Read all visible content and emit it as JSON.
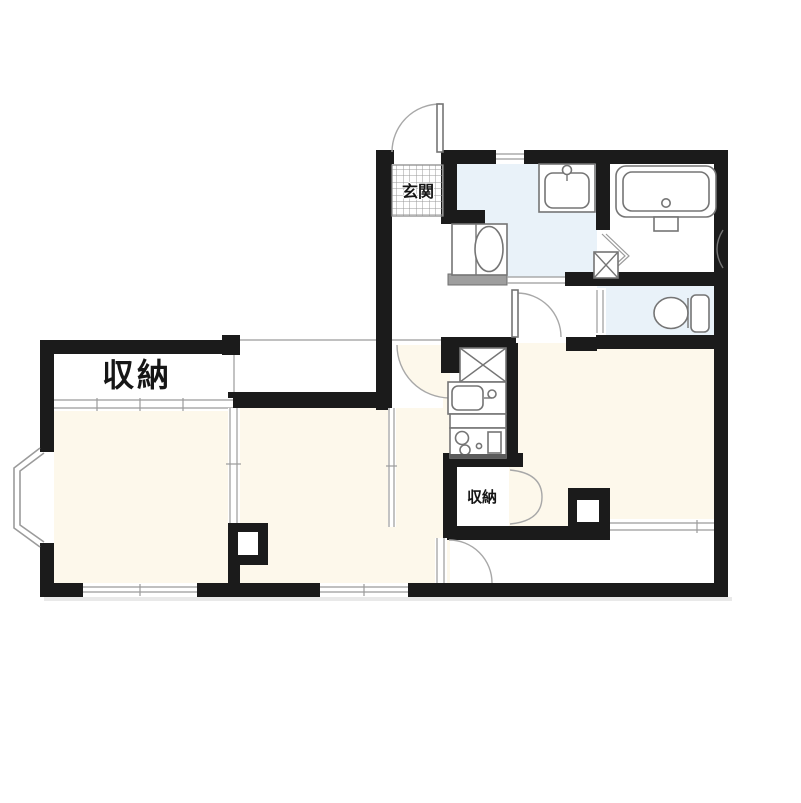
{
  "page": {
    "background": "#ffffff"
  },
  "floorplan": {
    "labels": {
      "entrance": "玄関",
      "storage_large": "収納",
      "storage_small": "収納"
    },
    "colors": {
      "wall": "#1b1b1b",
      "room_floor": "#FDF8EB",
      "wet_area_floor": "#E9F2F9",
      "fixture_line": "#757575",
      "thin_line": "#9b9b9b",
      "threshold": "#9e9e9e"
    },
    "fixtures": [
      "bathtub",
      "vanity-sink",
      "washing-machine",
      "toilet",
      "pipe-space",
      "refrigerator-space",
      "kitchen-sink",
      "gas-stove",
      "bay-window"
    ]
  }
}
